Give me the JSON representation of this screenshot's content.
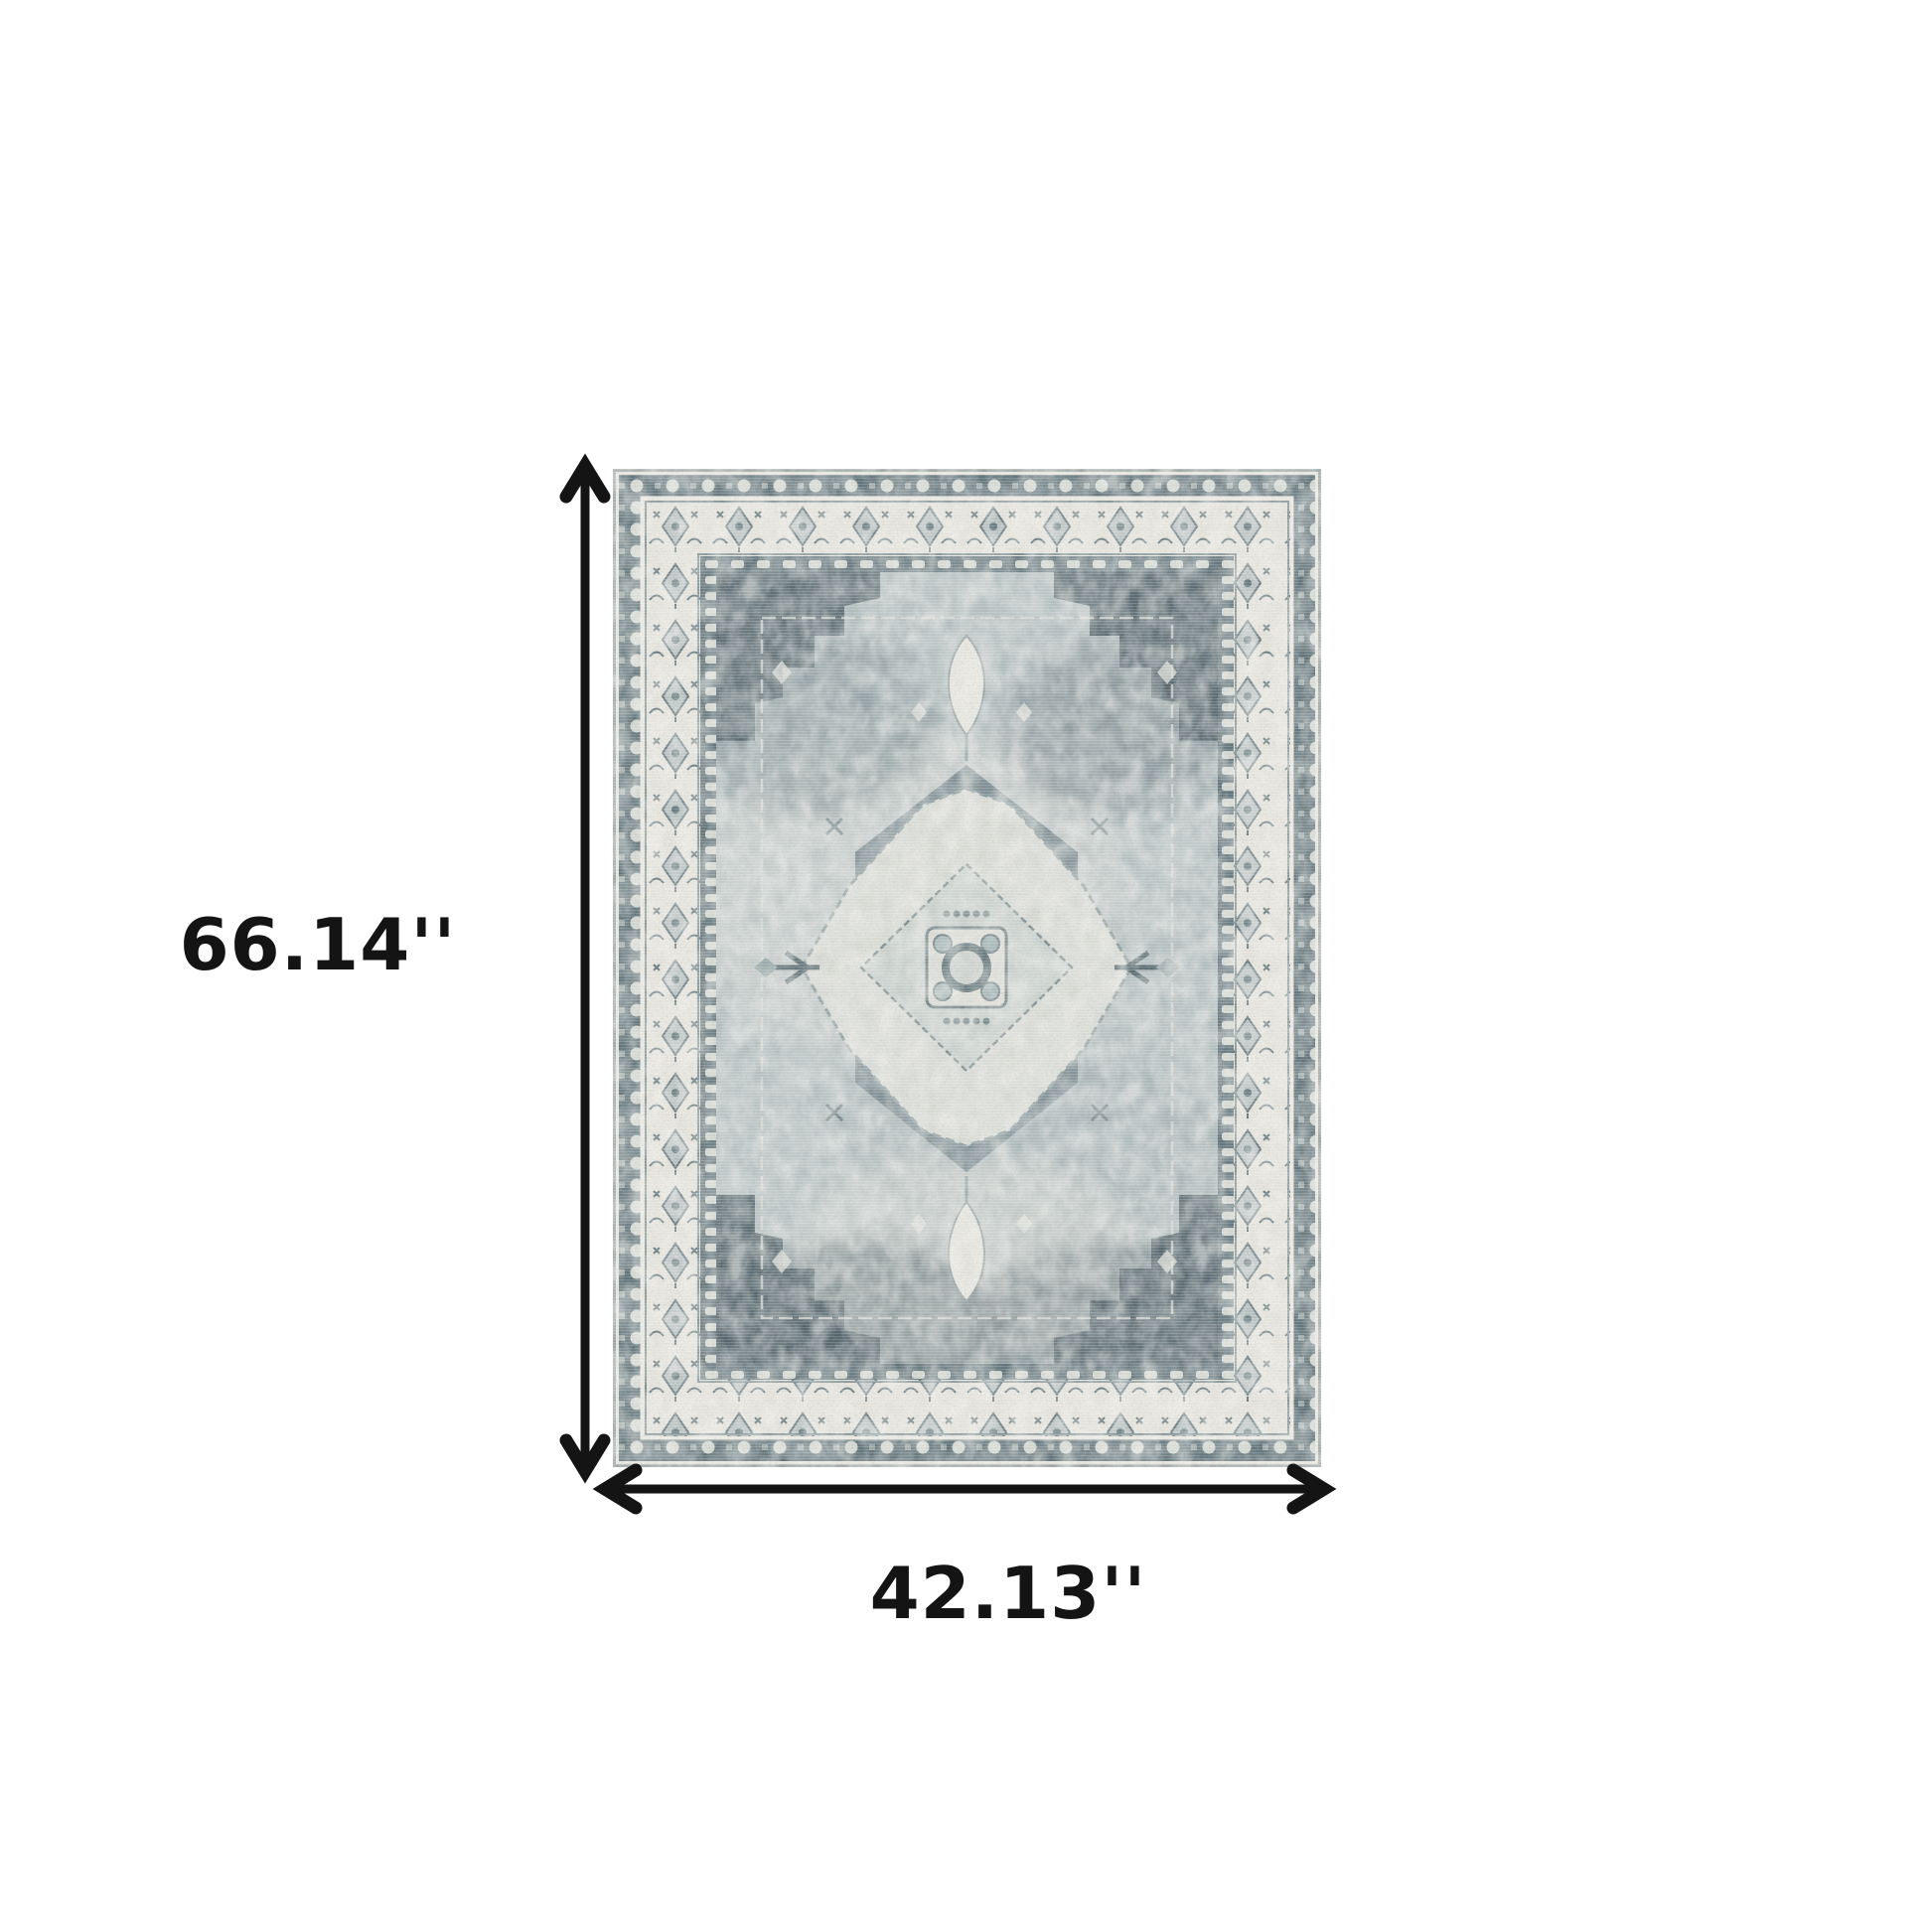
{
  "diagram": {
    "type": "product-dimensions",
    "subject": "Vintage distressed oriental medallion area rug in ivory, gray and slate blue",
    "height_label": "66.14''",
    "width_label": "42.13''",
    "background_color": "#ffffff",
    "annotation_color": "#141414",
    "rug_colors": {
      "ivory_border": "#e6e4dd",
      "slate_border_band": "#5f7278",
      "field_gray_blue": "#b2bdbe",
      "spandrel_dark": "#485a61",
      "medallion_light": "#d6d8d2"
    }
  }
}
